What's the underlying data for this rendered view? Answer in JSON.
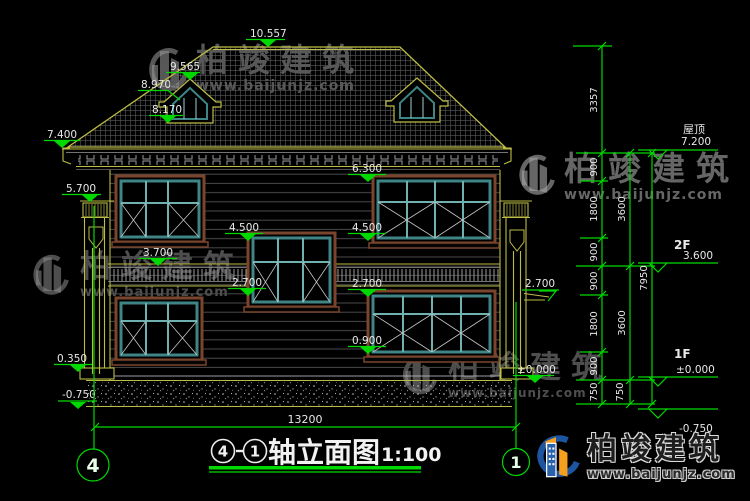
{
  "watermark": {
    "brand": "柏竣建筑",
    "url": "www.baijunjz.com"
  },
  "title": {
    "axis_start": "4",
    "axis_end": "1",
    "name": "轴立面图",
    "scale": "1:100"
  },
  "axis_bubbles": {
    "left": "4",
    "right": "1"
  },
  "facade_levels": {
    "ridge": "10.557",
    "dormer_peak": "9.565",
    "dormer_eave": "8.970",
    "dormer_base": "8.170",
    "left_eave": "7.400",
    "left_column_top": "5.700",
    "window_head_2f": "6.300",
    "window_sill_2f_left": "4.500",
    "window_sill_2f_right": "4.500",
    "belt_course": "3.700",
    "stair_sill_left": "2.700",
    "stair_sill_right": "2.700",
    "side_canopy": "2.700",
    "window_sill_1f": "0.900",
    "ground": "±0.000",
    "plinth": "0.350",
    "site": "-0.750"
  },
  "story_levels": {
    "roof_label": "屋顶",
    "roof_value": "7.200",
    "f2_label": "2F",
    "f2_value": "3.600",
    "f1_label": "1F",
    "f1_value": "±0.000",
    "base_value": "-0.750"
  },
  "dimensions": {
    "chain_inner": [
      "3357",
      "900",
      "1800",
      "900",
      "900",
      "1800",
      "900",
      "750"
    ],
    "chain_mid": [
      "3600",
      "3600",
      "750"
    ],
    "chain_outer": [
      "7950"
    ],
    "overall_width": "13200"
  }
}
